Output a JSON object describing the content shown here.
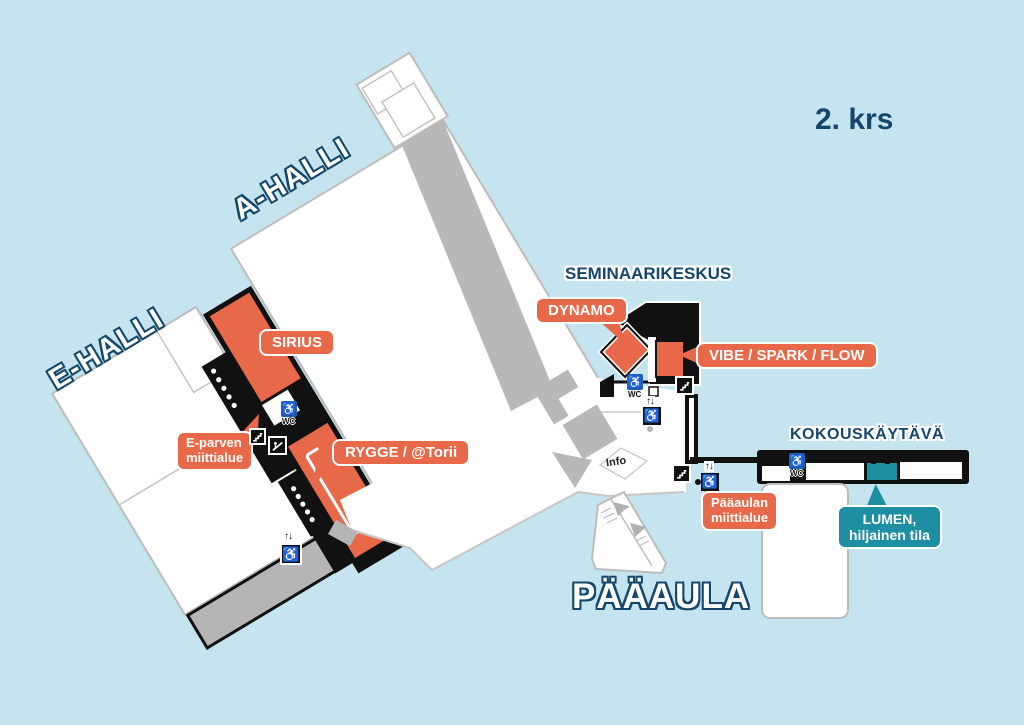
{
  "labels": {
    "floor": "2. krs",
    "hall_a": "A-HALLI",
    "hall_e": "E-HALLI",
    "seminar": "SEMINAARIKESKUS",
    "meeting_corridor": "KOKOUSKÄYTÄVÄ",
    "main_lobby": "PÄÄAULA",
    "info": "Info"
  },
  "bubbles": {
    "sirius": {
      "text": "SIRIUS"
    },
    "dynamo": {
      "text": "DYNAMO"
    },
    "vibe": {
      "text": "VIBE / SPARK / FLOW"
    },
    "rygge": {
      "text": "RYGGE / @Torii"
    },
    "e_parvi": {
      "line1": "E-parven",
      "line2": "miittialue"
    },
    "paaaulan": {
      "line1": "Pääaulan",
      "line2": "miittialue"
    },
    "lumen": {
      "line1": "LUMEN,",
      "line2": "hiljainen tila"
    }
  },
  "icons": {
    "wc_label": "WC",
    "elevator_arrows": "↑↓",
    "wheelchair": "♿"
  },
  "colors": {
    "background": "#c6e4ef",
    "navy": "#15476b",
    "orange": "#e8694a",
    "teal": "#1e8fa2",
    "wc_blue": "#1b63b5",
    "building": "#ffffff",
    "wall_gray": "#b7b8b7",
    "black": "#111111"
  }
}
